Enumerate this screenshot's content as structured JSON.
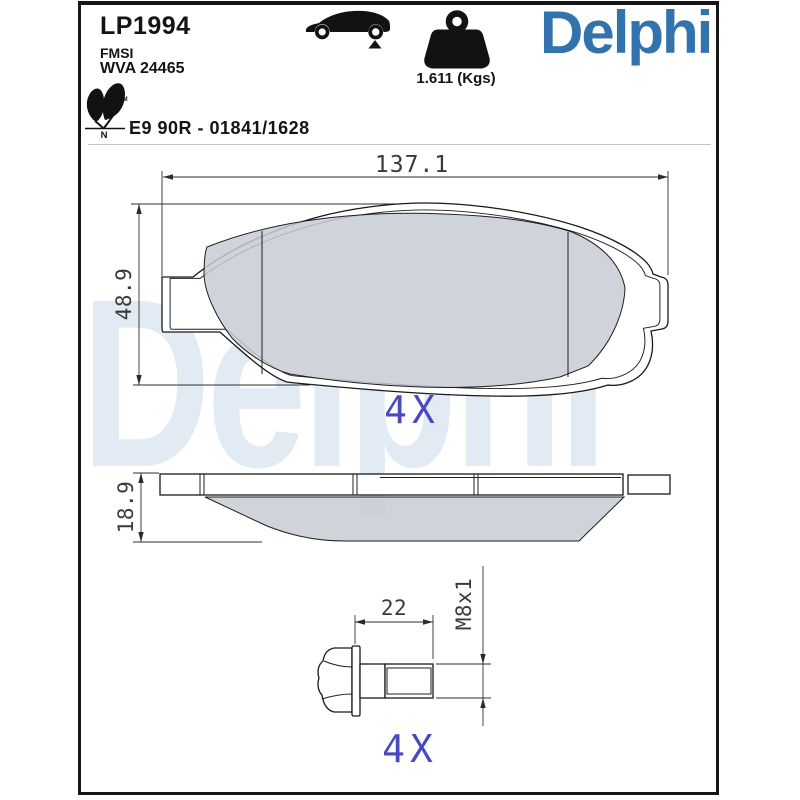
{
  "header": {
    "part_number": "LP1994",
    "fmsi_label": "FMSI",
    "wva_number": "WVA 24465",
    "weight_label": "1.611 (Kgs)",
    "brand_logo": "Delphi",
    "approval_code": "E9 90R - 01841/1628",
    "eco_mark_letter": "N",
    "trademark_symbol": "TM"
  },
  "watermark_text": "Delphi",
  "front_view": {
    "width_dim": "137.1",
    "height_dim": "48.9",
    "quantity_label": "4X"
  },
  "profile_view": {
    "thickness_dim": "18.9"
  },
  "bolt_view": {
    "thread_length_dim": "22",
    "thread_spec_dim": "M8x1",
    "quantity_label": "4X"
  },
  "colors": {
    "brand_blue": "#3272ad",
    "quantity_blue": "#4a4ac0",
    "dimension_gray": "#3a3a3a",
    "friction_gray": "#c7cbd3",
    "watermark_blue": "rgba(51,112,173,0.14)"
  }
}
